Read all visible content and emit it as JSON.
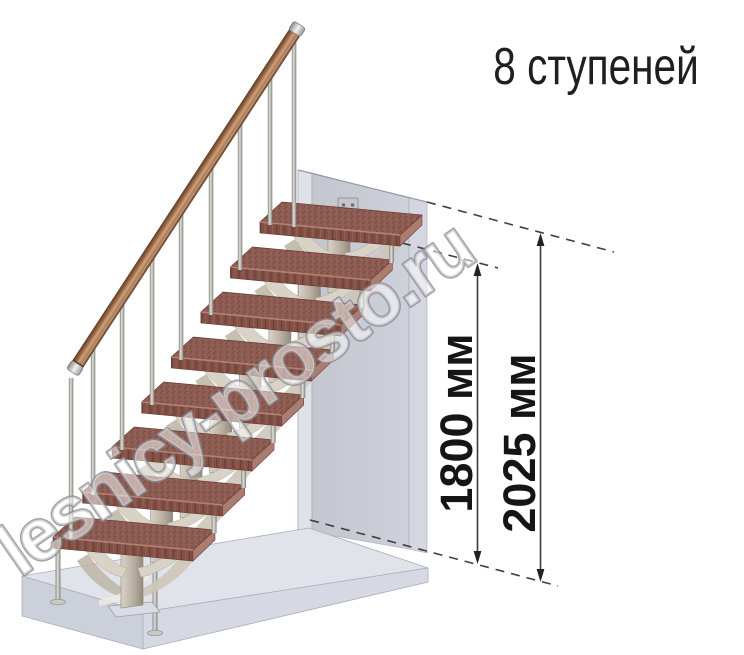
{
  "title": "8 ступеней",
  "watermark": "lesnicy-prosto.ru",
  "dimensions": {
    "to_last_step": "1800 мм",
    "floor_to_floor": "2025 мм"
  },
  "steps_count": 8,
  "palette": {
    "tread_top": "#8d5c52",
    "tread_front": "#835046",
    "tread_end": "#aa7d71",
    "handrail_wood": "#a97a55",
    "metal_post": "#b5b5b1",
    "stringer_beige": "#d8d2c7",
    "wall_gray": "#c7c9d3",
    "floor_gray": "#e1e3eb",
    "annotation_dark": "#3c3c40",
    "title_color": "#1f1f1f",
    "watermark_gray": "#8c8c94"
  }
}
